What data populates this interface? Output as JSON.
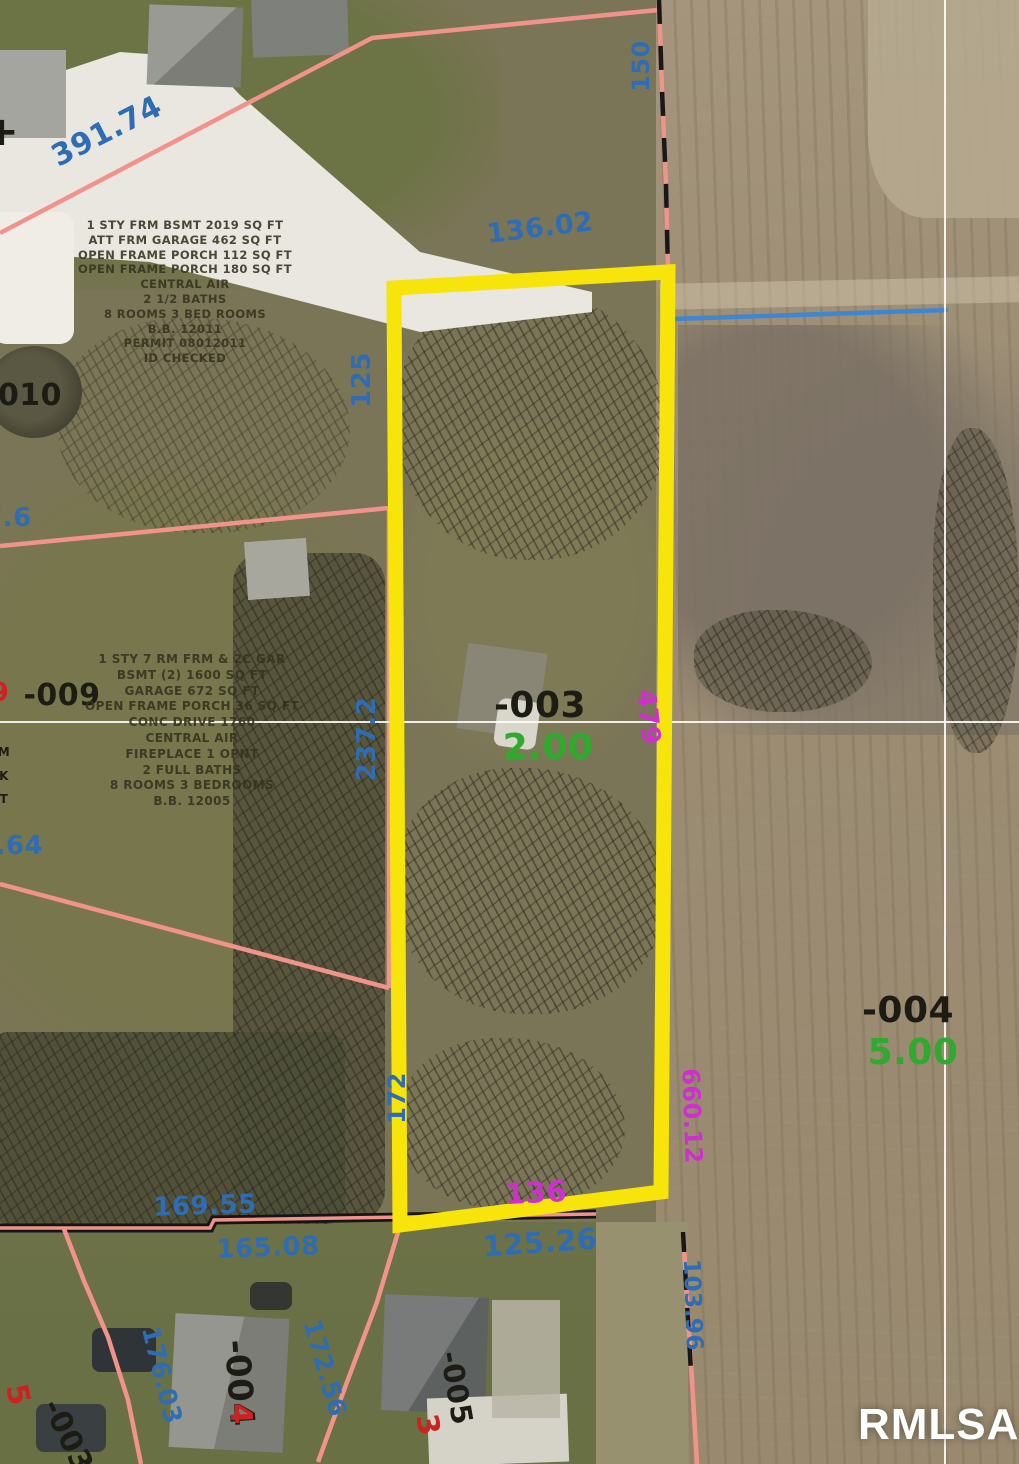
{
  "watermark": {
    "text": "RMLSA"
  },
  "map": {
    "legend_colors": {
      "dimension_blue": "#2e6db4",
      "area_green": "#2faa2f",
      "parcel_black": "#1c1c14",
      "dimension_magenta": "#cf2fcf",
      "lot_red": "#cc2222",
      "boundary_pink": "#f2938b",
      "highlight_yellow": "#f6e40a",
      "water_blue": "#3f86d2"
    },
    "parcel_labels": [
      {
        "id": "dim-391-74",
        "text": "391.74",
        "color": "dimension_blue",
        "x": 107,
        "y": 132,
        "rot": -27,
        "size": 30
      },
      {
        "id": "dim-136-02",
        "text": "136.02",
        "color": "dimension_blue",
        "x": 540,
        "y": 228,
        "rot": -7,
        "size": 27
      },
      {
        "id": "dim-150",
        "text": "150",
        "color": "dimension_blue",
        "x": 641,
        "y": 66,
        "rot": -90,
        "size": 24
      },
      {
        "id": "dim-125",
        "text": "125",
        "color": "dimension_blue",
        "x": 362,
        "y": 380,
        "rot": -90,
        "size": 26
      },
      {
        "id": "dim-237-2",
        "text": "237.2",
        "color": "dimension_blue",
        "x": 367,
        "y": 739,
        "rot": -90,
        "size": 26
      },
      {
        "id": "dim-172",
        "text": "172",
        "color": "dimension_blue",
        "x": 397,
        "y": 1098,
        "rot": -90,
        "size": 24
      },
      {
        "id": "dim-169-55",
        "text": "169.55",
        "color": "dimension_blue",
        "x": 205,
        "y": 1206,
        "rot": -2,
        "size": 26
      },
      {
        "id": "dim-165-08",
        "text": "165.08",
        "color": "dimension_blue",
        "x": 268,
        "y": 1248,
        "rot": -2,
        "size": 26
      },
      {
        "id": "dim-125-26",
        "text": "125.26",
        "color": "dimension_blue",
        "x": 540,
        "y": 1243,
        "rot": -4,
        "size": 29
      },
      {
        "id": "dim-7-6",
        "text": "7.6",
        "color": "dimension_blue",
        "x": 8,
        "y": 518,
        "rot": 0,
        "size": 26
      },
      {
        "id": "dim-4-64",
        "text": "4.64",
        "color": "dimension_blue",
        "x": 10,
        "y": 846,
        "rot": 0,
        "size": 26
      },
      {
        "id": "dim-176-03",
        "text": "176.03",
        "color": "dimension_blue",
        "x": 162,
        "y": 1375,
        "rot": 76,
        "size": 25
      },
      {
        "id": "dim-172-56",
        "text": "172.56",
        "color": "dimension_blue",
        "x": 325,
        "y": 1368,
        "rot": 74,
        "size": 25
      },
      {
        "id": "dim-103-96",
        "text": "103.96",
        "color": "dimension_blue",
        "x": 692,
        "y": 1305,
        "rot": 88,
        "size": 23
      },
      {
        "id": "lot-010",
        "text": "010",
        "color": "parcel_black",
        "x": 30,
        "y": 396,
        "rot": 0,
        "size": 30
      },
      {
        "id": "lot-009",
        "text": "-009",
        "color": "parcel_black",
        "x": 62,
        "y": 696,
        "rot": 0,
        "size": 30
      },
      {
        "id": "lot-003",
        "text": "-003",
        "color": "parcel_black",
        "x": 540,
        "y": 706,
        "rot": 0,
        "size": 36
      },
      {
        "id": "lot-004",
        "text": "-004",
        "color": "parcel_black",
        "x": 908,
        "y": 1011,
        "rot": 0,
        "size": 36
      },
      {
        "id": "lot-004-sw",
        "text": "-004",
        "color": "parcel_black",
        "x": 239,
        "y": 1383,
        "rot": 86,
        "size": 34
      },
      {
        "id": "lot-005-sw",
        "text": "-005",
        "color": "parcel_black",
        "x": 456,
        "y": 1388,
        "rot": 80,
        "size": 29
      },
      {
        "id": "lot-003-sw",
        "text": "-003",
        "color": "parcel_black",
        "x": 67,
        "y": 1436,
        "rot": 64,
        "size": 30
      },
      {
        "id": "cross-mark",
        "text": "+",
        "color": "parcel_black",
        "x": 2,
        "y": 132,
        "rot": 0,
        "size": 40
      },
      {
        "id": "frag-m",
        "text": "M",
        "color": "parcel_black",
        "x": 4,
        "y": 752,
        "rot": 0,
        "size": 12
      },
      {
        "id": "frag-k",
        "text": "K",
        "color": "parcel_black",
        "x": 4,
        "y": 776,
        "rot": 0,
        "size": 12
      },
      {
        "id": "frag-t",
        "text": "T",
        "color": "parcel_black",
        "x": 4,
        "y": 799,
        "rot": 0,
        "size": 12
      },
      {
        "id": "acres-2-00",
        "text": "2.00",
        "color": "area_green",
        "x": 548,
        "y": 748,
        "rot": 0,
        "size": 36
      },
      {
        "id": "acres-5-00",
        "text": "5.00",
        "color": "area_green",
        "x": 913,
        "y": 1053,
        "rot": 0,
        "size": 36
      },
      {
        "id": "dim-479",
        "text": "479",
        "color": "dimension_magenta",
        "x": 648,
        "y": 717,
        "rot": 84,
        "size": 26
      },
      {
        "id": "dim-660-12",
        "text": "660.12",
        "color": "dimension_magenta",
        "x": 692,
        "y": 1116,
        "rot": 88,
        "size": 24
      },
      {
        "id": "dim-136",
        "text": "136",
        "color": "dimension_magenta",
        "x": 536,
        "y": 1193,
        "rot": -3,
        "size": 29
      },
      {
        "id": "lotno-5",
        "text": "5",
        "color": "lot_red",
        "x": 17,
        "y": 1395,
        "rot": 78,
        "size": 30
      },
      {
        "id": "lotno-4",
        "text": "4",
        "color": "lot_red",
        "x": 240,
        "y": 1414,
        "rot": 88,
        "size": 30
      },
      {
        "id": "lotno-3",
        "text": "3",
        "color": "lot_red",
        "x": 427,
        "y": 1425,
        "rot": 80,
        "size": 30
      },
      {
        "id": "lotno-9-frag",
        "text": "9",
        "color": "lot_red",
        "x": 0,
        "y": 693,
        "rot": 0,
        "size": 26
      }
    ],
    "description_blocks": [
      {
        "id": "property-desc-north",
        "x": 185,
        "y": 218,
        "width": 320,
        "font_size": 11.5,
        "line_height": 14.8,
        "lines": [
          "1 STY FRM BSMT 2019 SQ FT",
          "ATT FRM GARAGE 462 SQ FT",
          "OPEN FRAME PORCH 112 SQ FT",
          "OPEN FRAME PORCH 180 SQ FT",
          "CENTRAL AIR",
          "2 1/2 BATHS",
          "8 ROOMS 3 BED ROOMS",
          "B.B. 12011",
          "PERMIT 08012011",
          "ID CHECKED"
        ]
      },
      {
        "id": "property-desc-south",
        "x": 192,
        "y": 652,
        "width": 330,
        "font_size": 12,
        "line_height": 15.8,
        "lines": [
          "1 STY 7 RM FRM & 2C GAR",
          "BSMT (2) 1600 SQ FT",
          "GARAGE 672 SQ FT",
          "OPEN FRAME PORCH 36 SQ FT",
          "CONC DRIVE 1760",
          "CENTRAL AIR",
          "FIREPLACE 1 OPNT",
          "2 FULL BATHS",
          "8 ROOMS 3 BEDROOMS",
          "B.B. 12005"
        ]
      }
    ]
  }
}
